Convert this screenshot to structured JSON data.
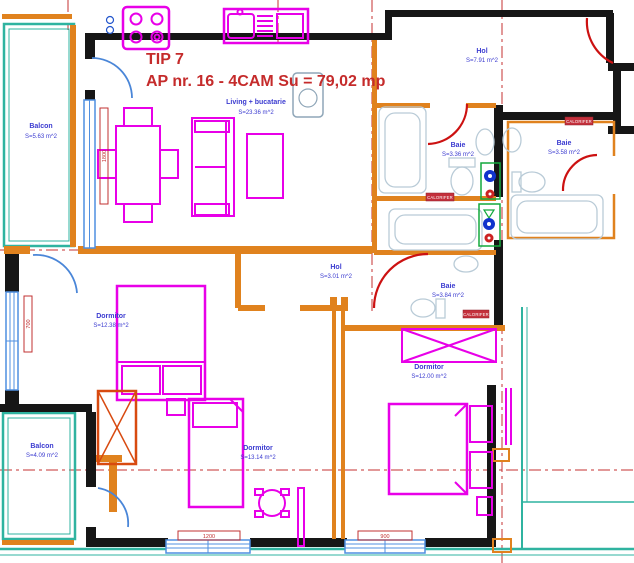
{
  "title": {
    "line1": "TIP 7",
    "line2": "AP nr. 16 - 4CAM Su = 79,02 mp"
  },
  "rooms": {
    "balcon_top": {
      "name": "Balcon",
      "area": "S=5.63 m^2"
    },
    "living": {
      "name": "Living + bucatarie",
      "area": "S=23.36 m^2"
    },
    "hol_entry": {
      "name": "Hol",
      "area": "S=7.91 m^2"
    },
    "baie_1": {
      "name": "Baie",
      "area": "S=3.36 m^2"
    },
    "baie_2": {
      "name": "Baie",
      "area": "S=3.58 m^2"
    },
    "hol_mid": {
      "name": "Hol",
      "area": "S=3.01 m^2"
    },
    "baie_3": {
      "name": "Baie",
      "area": "S=3.84 m^2"
    },
    "dorm_1": {
      "name": "Dormitor",
      "area": "S=12.38 m^2"
    },
    "dorm_2": {
      "name": "Dormitor",
      "area": "S=12.00 m^2"
    },
    "dorm_3": {
      "name": "Dormitor",
      "area": "S=13.14 m^2"
    },
    "balcon_bottom": {
      "name": "Balcon",
      "area": "S=4.09 m^2"
    }
  },
  "radiator_label": "CALORIFER",
  "dimensions": {
    "living_window": "1800",
    "dorm1_window": "700",
    "dorm3_window": "1200",
    "dorm2_window": "900"
  },
  "colors": {
    "exterior_wall": "#161616",
    "interior_wall_orange": "#e0821e",
    "furniture_magenta": "#e800e8",
    "balcony_teal": "#2fb3a0",
    "window_blue": "#4f8fe0",
    "label_blue": "#3b3bd0",
    "title_red": "#c52b2b",
    "axis_red": "#c53030",
    "radiator_red": "#c4303c",
    "fixture_gray": "#b9cbd7",
    "shaft_green": "#12a83c"
  }
}
